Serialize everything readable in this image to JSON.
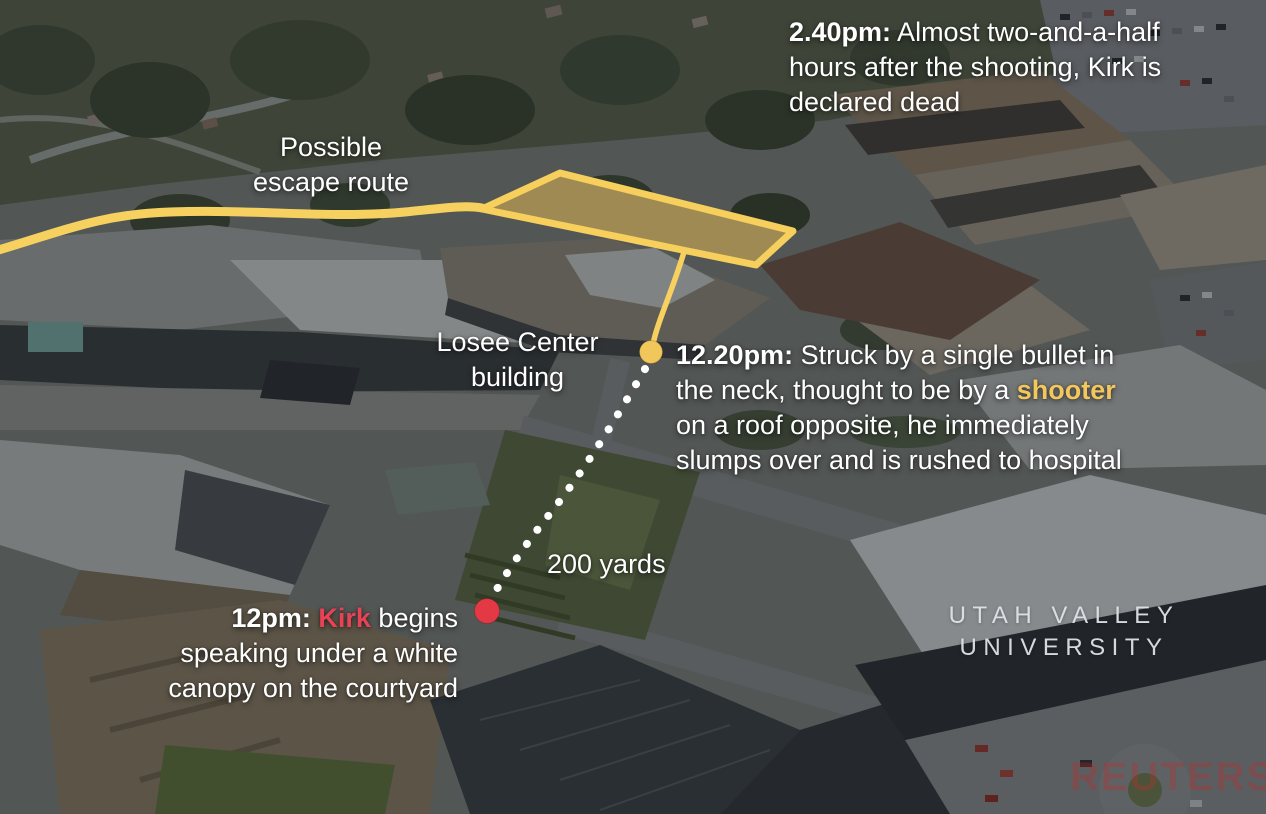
{
  "map": {
    "location_label": {
      "line1": "UTAH VALLEY",
      "line2": "UNIVERSITY"
    },
    "watermark": "REUTERS"
  },
  "labels": {
    "escape_route": {
      "line1": "Possible",
      "line2": "escape route"
    },
    "losee_center": {
      "line1": "Losee Center",
      "line2": "building"
    },
    "distance": "200 yards"
  },
  "events": {
    "declared_dead": {
      "time": "2.40pm:",
      "line1_rest": " Almost two-and-a-half",
      "line2": "hours after the shooting, Kirk is",
      "line3": "declared dead"
    },
    "shooting": {
      "time": "12.20pm:",
      "line1_rest": " Struck by a single bullet in",
      "line2_pre": "the neck, thought to be by a ",
      "line2_highlight": "shooter",
      "line3": "on a roof opposite, he immediately",
      "line4": "slumps over and is rushed to hospital"
    },
    "speech": {
      "time": "12pm: ",
      "line1_highlight": "Kirk",
      "line1_rest": " begins",
      "line2": "speaking under a white",
      "line3": "canopy on the courtyard"
    }
  },
  "colors": {
    "route_yellow": "#f7d15f",
    "roof_highlight_fill": "rgba(240,200,90,0.45)",
    "highlight_gold": "#f2c75e",
    "marker_red": "#e23944",
    "kirk_red": "#ea4255",
    "dotted_path_white": "#ffffff"
  }
}
